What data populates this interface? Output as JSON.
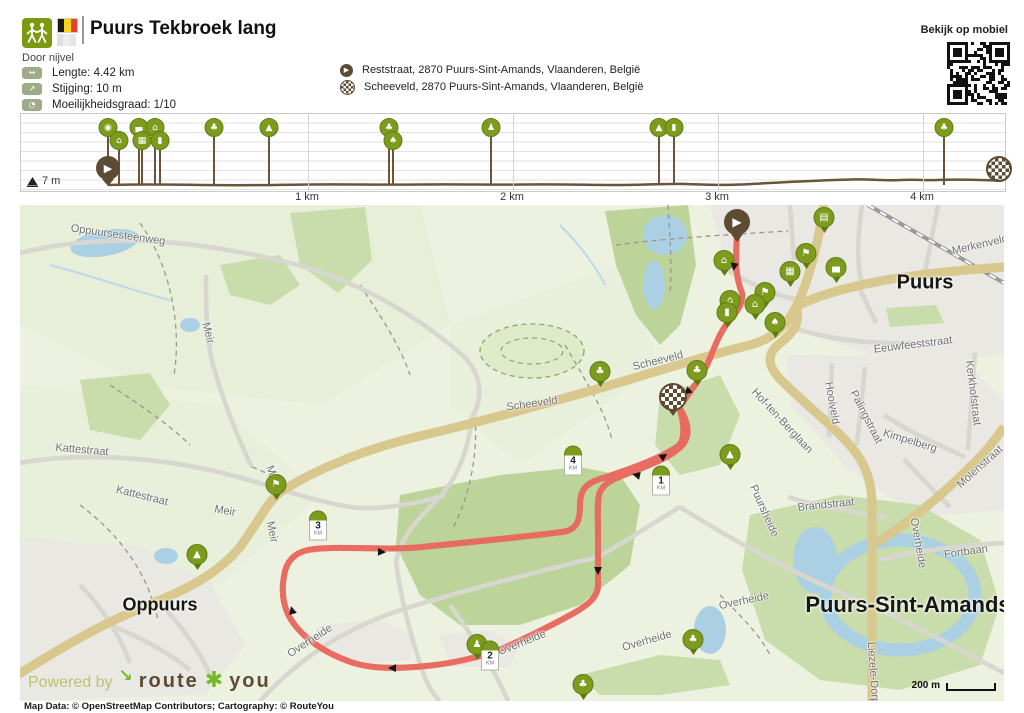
{
  "header": {
    "title": "Puurs Tekbroek lang",
    "author": "Door nijvel",
    "stats": [
      {
        "icon": "distance-icon",
        "glyph": "↔",
        "label": "Lengte: 4.42  km"
      },
      {
        "icon": "ascent-icon",
        "glyph": "↗",
        "label": "Stijging: 10  m"
      },
      {
        "icon": "difficulty-icon",
        "glyph": "◔",
        "label": "Moeilijkheidsgraad: 1/10"
      }
    ],
    "waypoints": [
      {
        "type": "start",
        "label": "Reststraat, 2870 Puurs-Sint-Amands, Vlaanderen, België"
      },
      {
        "type": "finish",
        "label": "Scheeveld, 2870 Puurs-Sint-Amands, Vlaanderen, België"
      }
    ],
    "mobile_label": "Bekijk op mobiel"
  },
  "profile": {
    "min_elevation": "7 m",
    "ticks": [
      {
        "label": "1 km",
        "x": 287
      },
      {
        "label": "2 km",
        "x": 492
      },
      {
        "label": "3 km",
        "x": 697
      },
      {
        "label": "4 km",
        "x": 902
      }
    ],
    "markers": [
      {
        "x": 87,
        "row": "t",
        "icon": "camera"
      },
      {
        "x": 98,
        "row": "b",
        "icon": "house"
      },
      {
        "x": 118,
        "row": "t",
        "icon": "hotel"
      },
      {
        "x": 121,
        "row": "b",
        "icon": "museum"
      },
      {
        "x": 134,
        "row": "t",
        "icon": "house"
      },
      {
        "x": 139,
        "row": "b",
        "icon": "monument"
      },
      {
        "x": 193,
        "row": "t",
        "icon": "tree"
      },
      {
        "x": 248,
        "row": "t",
        "icon": "hill"
      },
      {
        "x": 368,
        "row": "t",
        "icon": "tree"
      },
      {
        "x": 372,
        "row": "b",
        "icon": "plant"
      },
      {
        "x": 470,
        "row": "t",
        "icon": "statue"
      },
      {
        "x": 638,
        "row": "t",
        "icon": "hill"
      },
      {
        "x": 653,
        "row": "t",
        "icon": "monument"
      },
      {
        "x": 923,
        "row": "t",
        "icon": "tree"
      }
    ],
    "start_x": 87,
    "end_x": 978
  },
  "map": {
    "towns": [
      {
        "name": "Puurs",
        "x": 905,
        "y": 78,
        "size": 20
      },
      {
        "name": "Oppuurs",
        "x": 140,
        "y": 400,
        "size": 18
      },
      {
        "name": "Puurs-Sint-Amands",
        "x": 888,
        "y": 400,
        "size": 22
      }
    ],
    "streets": [
      {
        "t": "Oppuursesteenweg",
        "x": 98,
        "y": 30,
        "r": 8
      },
      {
        "t": "Meir",
        "x": 188,
        "y": 128,
        "r": 75
      },
      {
        "t": "Kattestraat",
        "x": 62,
        "y": 245,
        "r": 5
      },
      {
        "t": "Kattestraat",
        "x": 122,
        "y": 291,
        "r": 14
      },
      {
        "t": "Meir",
        "x": 253,
        "y": 271,
        "r": 68
      },
      {
        "t": "Meir",
        "x": 205,
        "y": 306,
        "r": 10
      },
      {
        "t": "Meir",
        "x": 252,
        "y": 327,
        "r": 78
      },
      {
        "t": "Scheeveld",
        "x": 512,
        "y": 199,
        "r": -8
      },
      {
        "t": "Scheeveld",
        "x": 638,
        "y": 156,
        "r": -14
      },
      {
        "t": "Merkenveld",
        "x": 960,
        "y": 40,
        "r": -13
      },
      {
        "t": "Eeuwfeeststraat",
        "x": 893,
        "y": 140,
        "r": -7
      },
      {
        "t": "Kerkhofstraat",
        "x": 953,
        "y": 188,
        "r": 83
      },
      {
        "t": "Hooiveld",
        "x": 812,
        "y": 198,
        "r": 80
      },
      {
        "t": "Palingstraat",
        "x": 846,
        "y": 212,
        "r": 63
      },
      {
        "t": "Kimpelberg",
        "x": 890,
        "y": 236,
        "r": 17
      },
      {
        "t": "Hof-ten-Berglaan",
        "x": 762,
        "y": 216,
        "r": 47
      },
      {
        "t": "Molenstraat",
        "x": 960,
        "y": 262,
        "r": -42
      },
      {
        "t": "Puursheide",
        "x": 744,
        "y": 306,
        "r": 66
      },
      {
        "t": "Brandstraat",
        "x": 806,
        "y": 300,
        "r": -6
      },
      {
        "t": "Overheide",
        "x": 290,
        "y": 436,
        "r": -33
      },
      {
        "t": "Overheide",
        "x": 502,
        "y": 438,
        "r": -22
      },
      {
        "t": "Overheide",
        "x": 627,
        "y": 436,
        "r": -16
      },
      {
        "t": "Overheide",
        "x": 724,
        "y": 396,
        "r": -12
      },
      {
        "t": "Overheide",
        "x": 898,
        "y": 338,
        "r": 80
      },
      {
        "t": "Fortbaan",
        "x": 946,
        "y": 347,
        "r": -8
      },
      {
        "t": "Liezele-Dorp",
        "x": 853,
        "y": 468,
        "r": 86
      }
    ],
    "km_markers": [
      {
        "n": "1",
        "x": 641,
        "y": 290
      },
      {
        "n": "2",
        "x": 470,
        "y": 465
      },
      {
        "n": "3",
        "x": 298,
        "y": 335
      },
      {
        "n": "4",
        "x": 553,
        "y": 270
      }
    ],
    "pois": [
      {
        "x": 704,
        "y": 66,
        "icon": "house"
      },
      {
        "x": 804,
        "y": 23,
        "icon": "bench"
      },
      {
        "x": 786,
        "y": 59,
        "icon": "flag"
      },
      {
        "x": 770,
        "y": 77,
        "icon": "museum"
      },
      {
        "x": 816,
        "y": 73,
        "icon": "hotel"
      },
      {
        "x": 745,
        "y": 98,
        "icon": "flag"
      },
      {
        "x": 710,
        "y": 106,
        "icon": "house"
      },
      {
        "x": 735,
        "y": 110,
        "icon": "house"
      },
      {
        "x": 707,
        "y": 118,
        "icon": "monument"
      },
      {
        "x": 755,
        "y": 128,
        "icon": "plant"
      },
      {
        "x": 677,
        "y": 176,
        "icon": "tree"
      },
      {
        "x": 580,
        "y": 177,
        "icon": "tree"
      },
      {
        "x": 710,
        "y": 260,
        "icon": "hill"
      },
      {
        "x": 673,
        "y": 445,
        "icon": "tree"
      },
      {
        "x": 457,
        "y": 450,
        "icon": "statue"
      },
      {
        "x": 563,
        "y": 490,
        "icon": "tree"
      },
      {
        "x": 256,
        "y": 290,
        "icon": "flag"
      },
      {
        "x": 177,
        "y": 360,
        "icon": "hill"
      }
    ],
    "arrows": [
      {
        "x": 714,
        "y": 62,
        "r": 100
      },
      {
        "x": 667,
        "y": 187,
        "r": 140
      },
      {
        "x": 616,
        "y": 270,
        "r": 192
      },
      {
        "x": 578,
        "y": 366,
        "r": 90
      },
      {
        "x": 468,
        "y": 448,
        "r": 190
      },
      {
        "x": 372,
        "y": 463,
        "r": 182
      },
      {
        "x": 272,
        "y": 405,
        "r": 255
      },
      {
        "x": 362,
        "y": 347,
        "r": 3
      },
      {
        "x": 644,
        "y": 251,
        "r": 325
      }
    ],
    "watermark": {
      "powered": "Powered by",
      "brand_a": "route",
      "star": "✱",
      "brand_b": "you",
      "arrow": "↘"
    },
    "scale_label": "200 m"
  },
  "footer": {
    "attribution": "Map Data: © OpenStreetMap Contributors; Cartography: ©  RouteYou"
  },
  "colors": {
    "brand_green": "#7d9c1e",
    "brand_brown": "#5d4b33",
    "route": "#f2837a",
    "road_yellow": "#f8eeb0",
    "water": "#abd0e4",
    "forest": "#c9dcab",
    "urban": "#e9e8e3"
  }
}
